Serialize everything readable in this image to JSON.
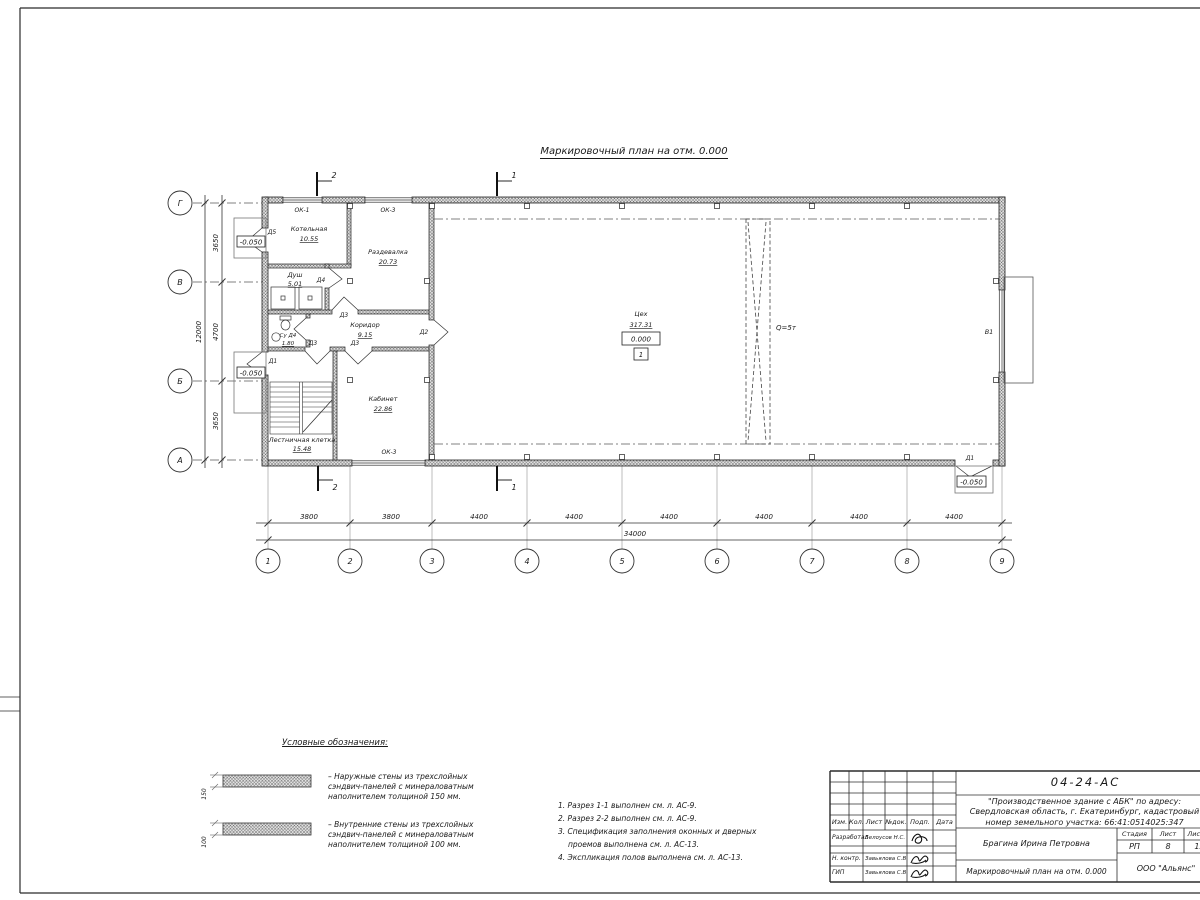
{
  "sheet": {
    "title": "Маркировочный план на отм. 0.000"
  },
  "plan": {
    "rooms": {
      "kotelnaya": {
        "name": "Котельная",
        "area": "10.55"
      },
      "razdevalka": {
        "name": "Раздевалка",
        "area": "20.73"
      },
      "dush": {
        "name": "Душ",
        "area": "5.01"
      },
      "su": {
        "name": "Су Д4",
        "area": "1.80"
      },
      "koridor": {
        "name": "Коридор",
        "area": "9.15"
      },
      "kabinet": {
        "name": "Кабинет",
        "area": "22.86"
      },
      "lestnitsa": {
        "name": "Лестничная клетка",
        "area": "15.48"
      },
      "tseh": {
        "name": "Цех",
        "area": "317.31"
      }
    },
    "marks": {
      "d1": "Д1",
      "d2": "Д2",
      "d3": "Д3",
      "d4": "Д4",
      "d5": "Д5",
      "ok1": "ОК-1",
      "ok3": "ОК-3",
      "v1": "В1",
      "crane": "Q=5т",
      "lvl_zero": "0.000",
      "lvl_minus": "-0.050",
      "floor_type": "1",
      "sec1": "1",
      "sec2": "2"
    }
  },
  "axes": {
    "cols": [
      "1",
      "2",
      "3",
      "4",
      "5",
      "6",
      "7",
      "8",
      "9"
    ],
    "rows": [
      "Г",
      "В",
      "Б",
      "А"
    ],
    "col_dims": [
      "3800",
      "3800",
      "4400",
      "4400",
      "4400",
      "4400",
      "4400",
      "4400"
    ],
    "col_total": "34000",
    "row_dims": [
      "3650",
      "4700",
      "3650"
    ],
    "row_total": "12000"
  },
  "legend": {
    "heading": "Условные обозначения:",
    "items": [
      {
        "dim": "150",
        "text": "–  Наружные стены из трехслойных сэндвич-панелей с минераловатным наполнителем толщиной 150 мм."
      },
      {
        "dim": "100",
        "text": "–  Внутренние стены из трехслойных сэндвич-панелей с минераловатным наполнителем толщиной 100 мм."
      }
    ]
  },
  "notes": [
    "1. Разрез 1-1 выполнен см. л. АС-9.",
    "2. Разрез 2-2 выполнен см. л. АС-9.",
    "3. Спецификация заполнения оконных и дверных проемов выполнена см. л. АС-13.",
    "4. Экспликация полов выполнена см. л. АС-13."
  ],
  "titleblock": {
    "doc_number": "04-24-АС",
    "project": "\"Производственное здание с АБК\" по адресу: Свердловская область, г. Екатеринбург, кадастровый номер земельного участка: 66:41:0514025:347",
    "columns": [
      "Изм.",
      "Кол.",
      "Лист",
      "№док.",
      "Подп.",
      "Дата"
    ],
    "staff": [
      {
        "role": "Разработал",
        "name": "Белоусов Н.С."
      },
      {
        "role": "Н. контр.",
        "name": "Завьялова С.В"
      },
      {
        "role": "ГИП",
        "name": "Завьялова С.В"
      }
    ],
    "supervisor": "Брагина Ирина Петровна",
    "stage_label": "Стадия",
    "sheet_label": "Лист",
    "sheets_label": "Листов",
    "stage": "РП",
    "sheet": "8",
    "sheets": "13",
    "drawing_title": "Маркировочный план на отм. 0.000",
    "company": "ООО \"Альянс\""
  }
}
